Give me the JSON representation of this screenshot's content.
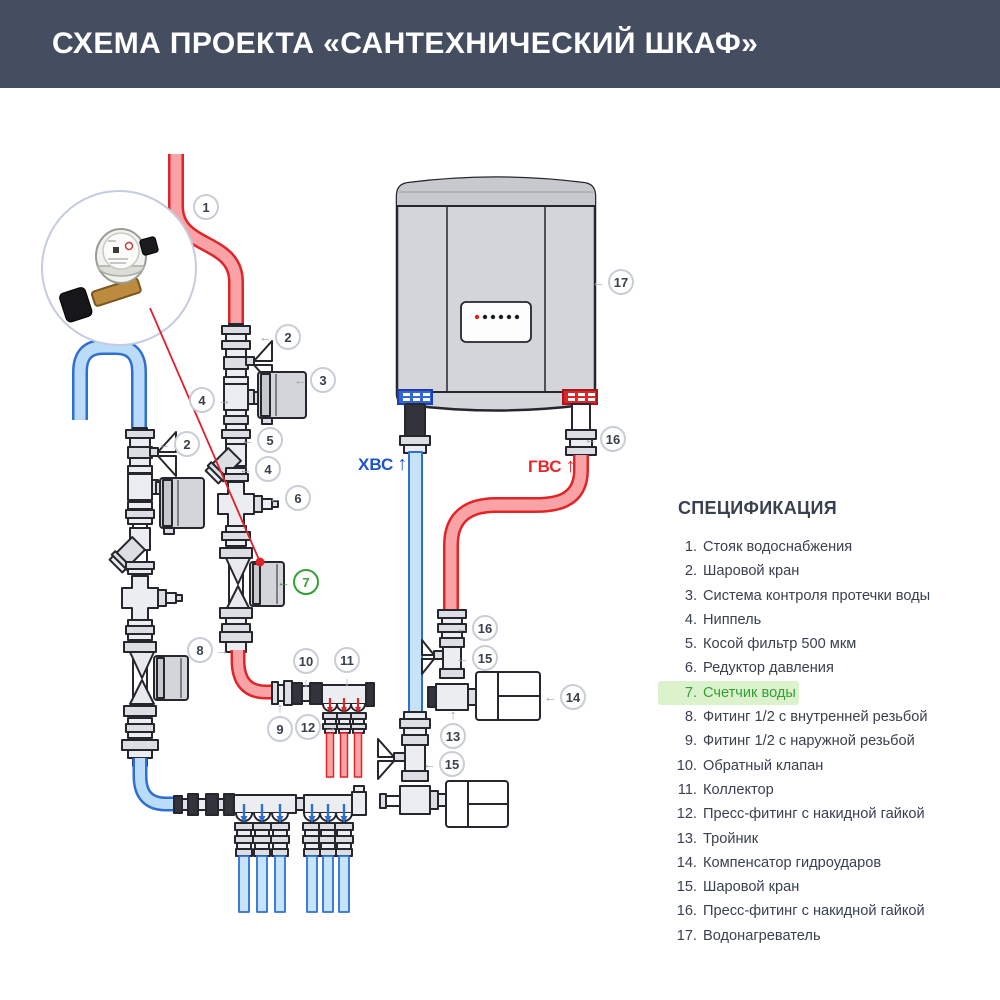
{
  "header": {
    "title": "СХЕМА ПРОЕКТА «САНТЕХНИЧЕСКИЙ ШКАФ»"
  },
  "spec": {
    "heading": "СПЕЦИФИКАЦИЯ",
    "items": [
      {
        "num": "1.",
        "label": "Стояк водоснабжения",
        "highlight": false
      },
      {
        "num": "2.",
        "label": "Шаровой кран",
        "highlight": false
      },
      {
        "num": "3.",
        "label": "Система контроля протечки воды",
        "highlight": false
      },
      {
        "num": "4.",
        "label": "Ниппель",
        "highlight": false
      },
      {
        "num": "5.",
        "label": "Косой фильтр 500 мкм",
        "highlight": false
      },
      {
        "num": "6.",
        "label": "Редуктор давления",
        "highlight": false
      },
      {
        "num": "7.",
        "label": "Счетчик воды",
        "highlight": true
      },
      {
        "num": "8.",
        "label": "Фитинг 1/2 с внутренней резьбой",
        "highlight": false
      },
      {
        "num": "9.",
        "label": "Фитинг 1/2 с наружной резьбой",
        "highlight": false
      },
      {
        "num": "10.",
        "label": "Обратный клапан",
        "highlight": false
      },
      {
        "num": "11.",
        "label": "Коллектор",
        "highlight": false
      },
      {
        "num": "12.",
        "label": "Пресс-фитинг с накидной гайкой",
        "highlight": false
      },
      {
        "num": "13.",
        "label": "Тройник",
        "highlight": false
      },
      {
        "num": "14.",
        "label": "Компенсатор гидроударов",
        "highlight": false
      },
      {
        "num": "15.",
        "label": "Шаровой кран",
        "highlight": false
      },
      {
        "num": "16.",
        "label": "Пресс-фитинг с накидной гайкой",
        "highlight": false
      },
      {
        "num": "17.",
        "label": "Водонагреватель",
        "highlight": false
      }
    ]
  },
  "flow_labels": {
    "cold": {
      "text": "ХВС",
      "arrow": "↑",
      "color": "#1C54CE",
      "x": 358,
      "y": 455
    },
    "hot": {
      "text": "ГВС",
      "arrow": "↑",
      "color": "#E8272A",
      "x": 528,
      "y": 457
    }
  },
  "callouts": [
    {
      "n": "1",
      "x": 206,
      "y": 207
    },
    {
      "n": "2",
      "x": 288,
      "y": 337,
      "arrow": "←",
      "side": "left"
    },
    {
      "n": "3",
      "x": 323,
      "y": 380,
      "arrow": "←",
      "side": "left"
    },
    {
      "n": "4",
      "x": 202,
      "y": 400,
      "arrow": "→",
      "side": "right"
    },
    {
      "n": "5",
      "x": 270,
      "y": 440,
      "arrow": "←",
      "side": "left"
    },
    {
      "n": "4",
      "x": 268,
      "y": 469,
      "arrow": "←",
      "side": "left"
    },
    {
      "n": "6",
      "x": 298,
      "y": 498,
      "arrow": "←",
      "side": "left"
    },
    {
      "n": "7",
      "x": 306,
      "y": 582,
      "arrow": "←",
      "side": "left",
      "green": true
    },
    {
      "n": "2",
      "x": 187,
      "y": 444,
      "arrow": "←",
      "side": "left"
    },
    {
      "n": "8",
      "x": 200,
      "y": 650,
      "arrow": "→",
      "side": "right"
    },
    {
      "n": "10",
      "x": 306,
      "y": 661,
      "arrow": "↓",
      "side": "bottom"
    },
    {
      "n": "11",
      "x": 347,
      "y": 660,
      "arrow": "↓",
      "side": "bottom"
    },
    {
      "n": "9",
      "x": 280,
      "y": 729,
      "arrow": "↑",
      "side": "top"
    },
    {
      "n": "12",
      "x": 308,
      "y": 727,
      "arrow": "→",
      "side": "right"
    },
    {
      "n": "16",
      "x": 485,
      "y": 628,
      "arrow": "←",
      "side": "left"
    },
    {
      "n": "15",
      "x": 485,
      "y": 658,
      "arrow": "←",
      "side": "left"
    },
    {
      "n": "14",
      "x": 573,
      "y": 697,
      "arrow": "←",
      "side": "left"
    },
    {
      "n": "13",
      "x": 453,
      "y": 736,
      "arrow": "↑",
      "side": "top"
    },
    {
      "n": "15",
      "x": 452,
      "y": 764,
      "arrow": "←",
      "side": "left"
    },
    {
      "n": "16",
      "x": 613,
      "y": 439,
      "arrow": "←",
      "side": "left"
    },
    {
      "n": "17",
      "x": 621,
      "y": 282,
      "arrow": "←",
      "side": "left"
    }
  ],
  "colors": {
    "header_bg": "#454D60",
    "hot_stroke": "#E02428",
    "hot_fill": "#F9A3A6",
    "cold_stroke": "#2E6FD1",
    "cold_fill": "#BBDCF8",
    "cold_light": "#C7E3FA",
    "green": "#33A036",
    "green_bg": "#DCF2CC",
    "text": "#39404F",
    "callout_border": "#C9CDD6",
    "outline": "#26272E"
  }
}
